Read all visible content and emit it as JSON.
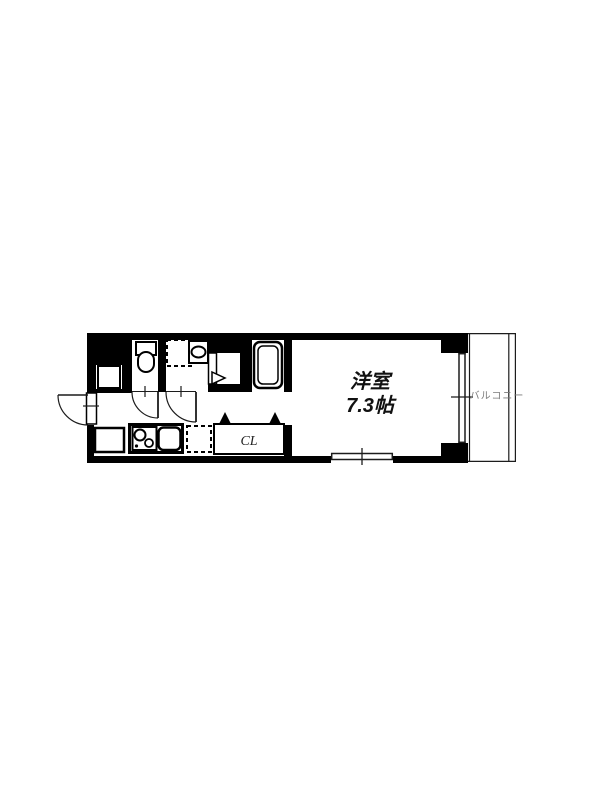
{
  "colors": {
    "background": "#ffffff",
    "wall": "#000000",
    "thin_line": "#1c1c1c",
    "room_label_color": "#111111",
    "balcony_label_color": "#7a7a7a"
  },
  "floorplan": {
    "western_room": {
      "name_label": "洋室",
      "size_label": "7.3帖"
    },
    "closet": {
      "label": "CL"
    },
    "balcony": {
      "label": "バルコニー"
    },
    "fixtures": [
      {
        "name": "toilet"
      },
      {
        "name": "washing-machine-space"
      },
      {
        "name": "washbasin"
      },
      {
        "name": "bathroom-door"
      },
      {
        "name": "bathtub"
      },
      {
        "name": "shoe-cabinet"
      },
      {
        "name": "entrance-storage"
      },
      {
        "name": "entrance-door"
      },
      {
        "name": "interior-door"
      },
      {
        "name": "gas-stove"
      },
      {
        "name": "kitchen-sink"
      },
      {
        "name": "refrigerator-space"
      },
      {
        "name": "closet-folding-door"
      },
      {
        "name": "window"
      },
      {
        "name": "sliding-glass-door"
      }
    ]
  }
}
